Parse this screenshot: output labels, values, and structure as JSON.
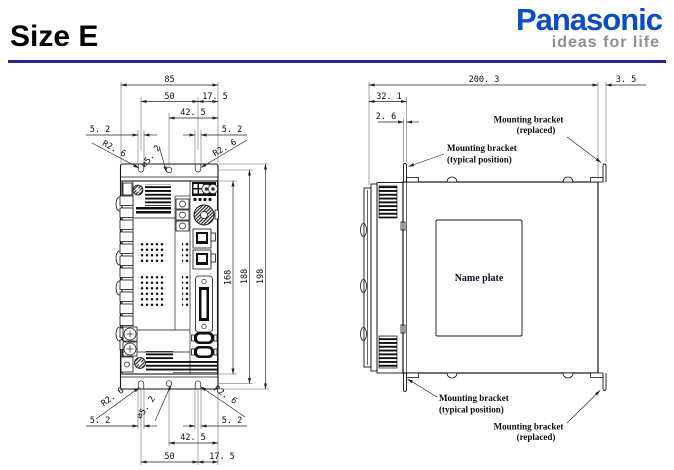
{
  "header": {
    "title": "Size E",
    "logo": "Panasonic",
    "tagline": "ideas for life",
    "colors": {
      "logo_blue": "#0a4ec4",
      "tagline_gray": "#8f8f8f",
      "rule_navy": "#28288e"
    }
  },
  "front": {
    "dims": {
      "overall_width": "85",
      "hole_span": "50",
      "right_offset": "17. 5",
      "center_offset": "42. 5",
      "slot_width": "5. 2",
      "slot_radius": "R2. 6",
      "hole_dia": "⌀5. 2",
      "face_height": "168",
      "hole_height": "188",
      "overall_height": "198"
    }
  },
  "side": {
    "dims": {
      "depth": "200. 3",
      "bracket_offset": "3. 5",
      "front_depth": "32. 1",
      "tab_thickness": "2. 6"
    },
    "name_plate": "Name plate",
    "labels": {
      "bracket": "Mounting bracket",
      "typical": "(typical position)",
      "replaced": "(replaced)"
    }
  }
}
